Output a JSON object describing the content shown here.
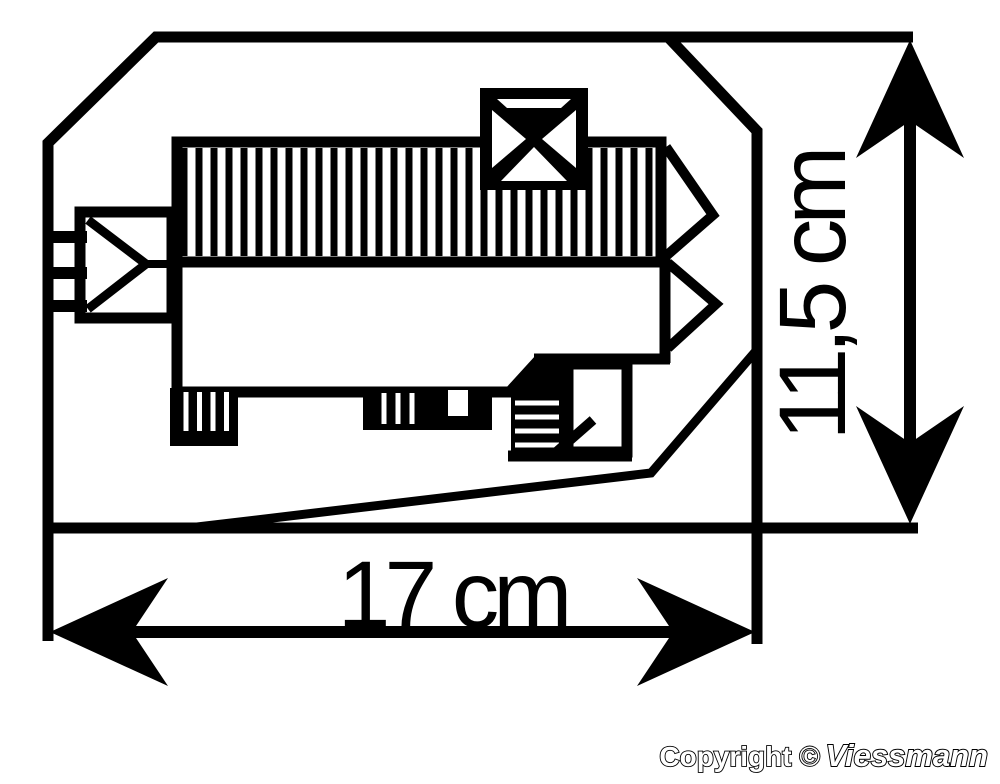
{
  "diagram": {
    "title": "building-footprint-dimension-drawing",
    "dimensions": {
      "width": {
        "label": "17 cm"
      },
      "height": {
        "label": "11,5 cm"
      }
    }
  },
  "footer": {
    "copyright": "Copyright ©",
    "brand": "Viessmann"
  },
  "colors": {
    "ink": "#000000",
    "paper": "#ffffff"
  }
}
